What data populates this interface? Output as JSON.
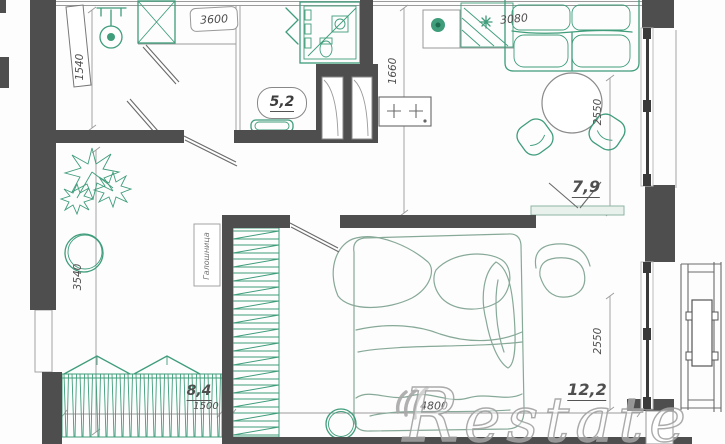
{
  "plan": {
    "room_labels": {
      "bathroom": "5,2",
      "living_kitchen": "7,9",
      "hallway": "8,4",
      "bedroom": "12,2"
    },
    "dimensions": {
      "closet_width": "3600",
      "entry_depth": "1540",
      "bath_kitchen_depth": "1660",
      "kitchen_width": "3080",
      "living_depth": "2550",
      "hallway_depth": "3540",
      "wardrobe_width": "1500",
      "bedroom_width": "4800",
      "bedroom_depth": "2550"
    },
    "annotations": {
      "shoe_cabinet": "Галошница"
    },
    "watermark": {
      "initial": "R",
      "rest": "estate"
    },
    "colors": {
      "wall": "#4e4e4e",
      "green": "#3f9d7b",
      "soft": "#87a998",
      "line": "#9b9b9b",
      "text": "#4f4f4f",
      "watermark": "#a2a2a2"
    }
  }
}
